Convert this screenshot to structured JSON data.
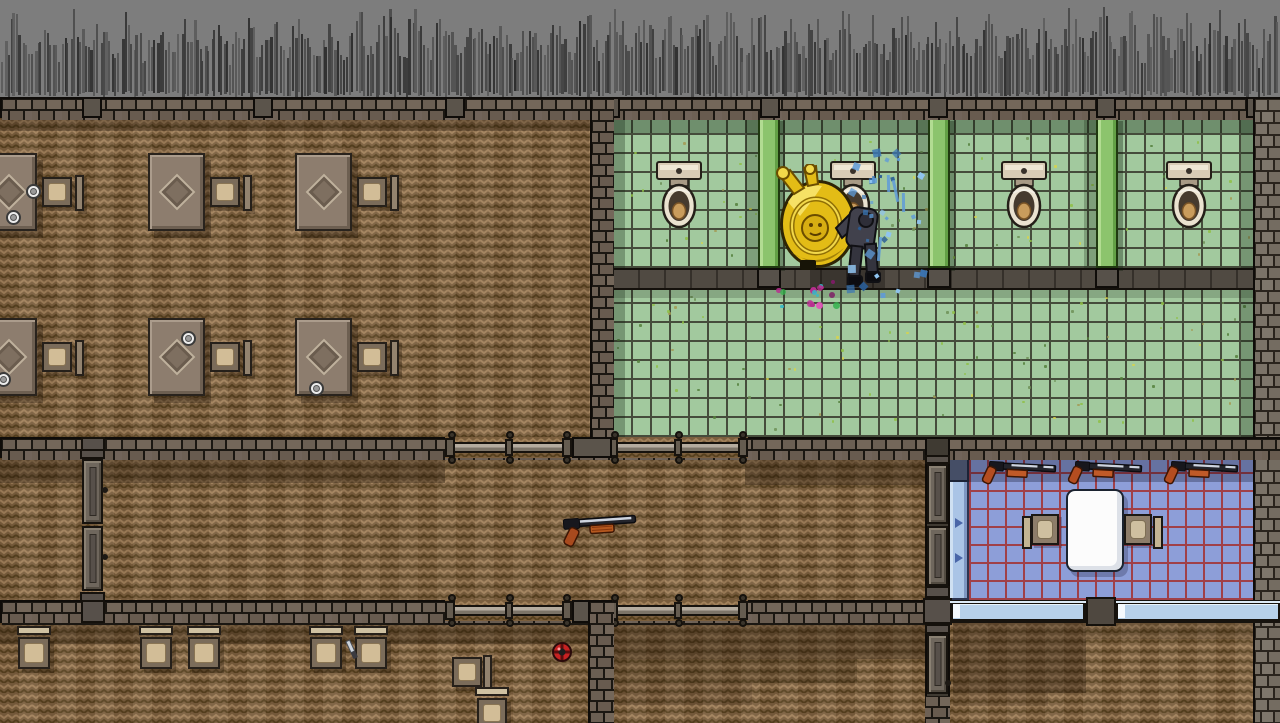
{
  "scene": {
    "label": "top-down pixel-art level: office, toilet stalls, corridor, gun room",
    "width": 1280,
    "height": 723
  },
  "palette": {
    "grass_bg": "#7d7d7d",
    "grass_blade": "#3f3f3f",
    "wall_brick": "#6e6156",
    "wall_mortar": "#1b1712",
    "wall_brick_light": "#7b7368",
    "wood_base": "#7a5e3d",
    "wood_light": "#a0805a",
    "wood_dark": "#57411f",
    "tile_green": "#a2c99e",
    "tile_grout_green": "#454c3b",
    "stall_divider_green": "#8cc46d",
    "walkway_gray": "#6e665c",
    "tile_blue": "#8d9ed8",
    "tile_grout_red": "#a04048",
    "bench_blue": "#aac4e6",
    "window_glass": "#b7d1ea",
    "table_white": "#fcfcfc",
    "toilet_tank": "#d9ccb6",
    "toilet_seat_tan": "#c99c5c",
    "gun_barrel": "#23242b",
    "gun_steel": "#cdd3de",
    "gun_pump_orange": "#c05a28",
    "mine_red": "#c62222",
    "knife_steel": "#cdd4dc",
    "splash_blue": "#5f9bd8",
    "splatter_pink": "#e055b8",
    "splatter_green": "#35b24d",
    "character_heavy_yellow": "#e3bc16",
    "character_suit_gray": "#41414c",
    "shadow": "rgba(30,18,6,0.33)"
  },
  "rooms": [
    {
      "id": "office",
      "label": "office with desks"
    },
    {
      "id": "toilet-stalls",
      "label": "toilet stalls"
    },
    {
      "id": "bathroom-floor",
      "label": "bathroom tiled floor"
    },
    {
      "id": "corridor",
      "label": "corridor"
    },
    {
      "id": "gun-room",
      "label": "gun room with wall shotguns"
    },
    {
      "id": "bottom-rooms",
      "label": "lower rooms with stools"
    }
  ],
  "layout": {
    "grass": {
      "x": 0,
      "y": 0,
      "w": 1280,
      "h": 97
    },
    "top_wall": {
      "x": 0,
      "y": 97,
      "w": 1280,
      "h": 21,
      "columns_x": [
        82,
        253,
        445,
        600,
        760,
        928,
        1096,
        1246
      ]
    },
    "office": {
      "floor": {
        "x": 0,
        "y": 118,
        "w": 590,
        "h": 319
      },
      "desks": [
        {
          "x": -20,
          "y": 153
        },
        {
          "x": 148,
          "y": 153
        },
        {
          "x": 295,
          "y": 153
        },
        {
          "x": -20,
          "y": 318
        },
        {
          "x": 148,
          "y": 318
        },
        {
          "x": 295,
          "y": 318
        }
      ],
      "chair_offset": {
        "dx": 62,
        "dy": 24,
        "back_dx": 95,
        "back_dy": 22
      },
      "plates": [
        {
          "x": 26,
          "y": 184
        },
        {
          "x": 6,
          "y": 210
        },
        {
          "x": 181,
          "y": 331
        },
        {
          "x": 309,
          "y": 381
        },
        {
          "x": -4,
          "y": 372
        }
      ]
    },
    "divider_wall": {
      "x": 590,
      "y": 97,
      "w": 22,
      "h": 361
    },
    "right_wall": {
      "x": 1253,
      "y": 97,
      "w": 27,
      "h": 626
    },
    "stalls": {
      "floor": {
        "x": 612,
        "y": 118,
        "w": 641,
        "h": 150
      },
      "dividers_x": [
        758,
        928,
        1096
      ],
      "toilets_cx": [
        679,
        853,
        1024,
        1189
      ],
      "toilet_y": 161
    },
    "walkway": {
      "x": 612,
      "y": 268,
      "w": 641,
      "h": 22
    },
    "bath_floor": {
      "x": 612,
      "y": 290,
      "w": 641,
      "h": 147
    },
    "mid_wall": {
      "x": 0,
      "y": 437,
      "w": 1280,
      "h": 21,
      "rails": [
        {
          "x": 445,
          "w": 127
        },
        {
          "x": 608,
          "w": 140
        }
      ],
      "column_x": 572,
      "door_x": 82
    },
    "corridor": {
      "floor": {
        "x": 0,
        "y": 458,
        "w": 950,
        "h": 142
      },
      "door": {
        "x": 82,
        "y": 449,
        "h": 153
      }
    },
    "gun_room": {
      "bench": {
        "x": 948,
        "y": 455,
        "w": 21,
        "h": 145
      },
      "floor": {
        "x": 969,
        "y": 455,
        "w": 284,
        "h": 145
      },
      "guns_x": [
        981,
        1067,
        1163
      ],
      "gun_y": 458,
      "table": {
        "x": 1066,
        "y": 489,
        "w": 58,
        "h": 83
      },
      "chairs": [
        {
          "x": 1022,
          "y": 514,
          "side": "left"
        },
        {
          "x": 1124,
          "y": 514,
          "side": "right"
        }
      ],
      "arrows": [
        {
          "x": 955,
          "y": 518
        },
        {
          "x": 955,
          "y": 553
        }
      ]
    },
    "bottom_wall": {
      "x": 0,
      "y": 600,
      "w": 950,
      "h": 23,
      "rails": [
        {
          "x": 445,
          "w": 127
        },
        {
          "x": 608,
          "w": 140
        }
      ],
      "column_x": 572,
      "door_x": 82
    },
    "window": {
      "x": 950,
      "y": 600,
      "w": 330,
      "h": 23,
      "post_x": 1086,
      "glass": [
        {
          "x": 953,
          "w": 130
        },
        {
          "x": 1118,
          "w": 160
        }
      ],
      "glass_y": 604,
      "glass_h": 14
    },
    "bottom_floor": {
      "x": 0,
      "y": 623,
      "w": 1280,
      "h": 100
    },
    "wall2": {
      "x": 588,
      "y": 600,
      "w": 24,
      "h": 123
    },
    "wall3": {
      "x": 925,
      "y": 437,
      "w": 25,
      "h": 286
    },
    "stools": {
      "xs": [
        18,
        140,
        188,
        310,
        355
      ],
      "y": 626
    },
    "side_chairs": [
      {
        "x": 452,
        "y": 657,
        "back": "right"
      },
      {
        "x": 477,
        "y": 691,
        "back": "top"
      }
    ],
    "items": {
      "floor_shotgun": {
        "x": 556,
        "y": 506
      },
      "mine": {
        "x": 551,
        "y": 641
      },
      "knife": {
        "x": 344,
        "y": 639
      }
    },
    "characters": {
      "heavy": {
        "x": 770,
        "y": 164
      },
      "suit": {
        "x": 826,
        "y": 194
      }
    },
    "effects": {
      "splash_center": {
        "x": 880,
        "y": 215
      },
      "splatter_center": {
        "x": 806,
        "y": 293
      }
    },
    "shadows": [
      {
        "x": 0,
        "y": 118,
        "w": 590,
        "h": 13,
        "c": "rgba(30,18,6,0.28)"
      },
      {
        "x": 612,
        "y": 118,
        "w": 641,
        "h": 15,
        "c": "rgba(18,34,16,0.35)"
      },
      {
        "x": 612,
        "y": 118,
        "w": 13,
        "h": 150,
        "c": "rgba(18,34,16,0.30)"
      },
      {
        "x": 1241,
        "y": 118,
        "w": 12,
        "h": 150,
        "c": "rgba(18,34,16,0.30)"
      },
      {
        "x": 612,
        "y": 268,
        "w": 641,
        "h": 20,
        "c": "rgba(12,10,6,0.30)"
      },
      {
        "x": 810,
        "y": 268,
        "w": 75,
        "h": 20,
        "c": "rgba(10,8,4,0.30)"
      },
      {
        "x": 612,
        "y": 290,
        "w": 641,
        "h": 8,
        "c": "rgba(12,18,8,0.18)"
      },
      {
        "x": 612,
        "y": 290,
        "w": 13,
        "h": 147,
        "c": "rgba(18,34,16,0.30)"
      },
      {
        "x": 1241,
        "y": 290,
        "w": 12,
        "h": 147,
        "c": "rgba(18,34,16,0.30)"
      },
      {
        "x": 0,
        "y": 458,
        "w": 445,
        "h": 25,
        "c": "rgba(30,18,6,0.35)"
      },
      {
        "x": 445,
        "y": 458,
        "w": 163,
        "h": 11,
        "c": "rgba(30,18,6,0.20)"
      },
      {
        "x": 608,
        "y": 458,
        "w": 137,
        "h": 11,
        "c": "rgba(30,18,6,0.20)"
      },
      {
        "x": 745,
        "y": 458,
        "w": 205,
        "h": 27,
        "c": "rgba(30,18,6,0.35)"
      },
      {
        "x": 969,
        "y": 455,
        "w": 284,
        "h": 27,
        "c": "rgba(12,14,34,0.30)"
      },
      {
        "x": 0,
        "y": 623,
        "w": 588,
        "h": 21,
        "c": "rgba(30,18,6,0.32)"
      },
      {
        "x": 612,
        "y": 623,
        "w": 323,
        "h": 36,
        "c": "rgba(30,18,6,0.33)"
      },
      {
        "x": 612,
        "y": 659,
        "w": 245,
        "h": 24,
        "c": "rgba(30,18,6,0.20)"
      },
      {
        "x": 612,
        "y": 683,
        "w": 140,
        "h": 22,
        "c": "rgba(30,18,6,0.13)"
      },
      {
        "x": 953,
        "y": 623,
        "w": 133,
        "h": 70,
        "c": "rgba(30,18,6,0.30)"
      },
      {
        "x": 1086,
        "y": 623,
        "w": 167,
        "h": 16,
        "c": "rgba(30,18,6,0.18)"
      },
      {
        "x": 953,
        "y": 693,
        "w": 95,
        "h": 13,
        "c": "rgba(30,18,6,0.12)"
      }
    ]
  }
}
